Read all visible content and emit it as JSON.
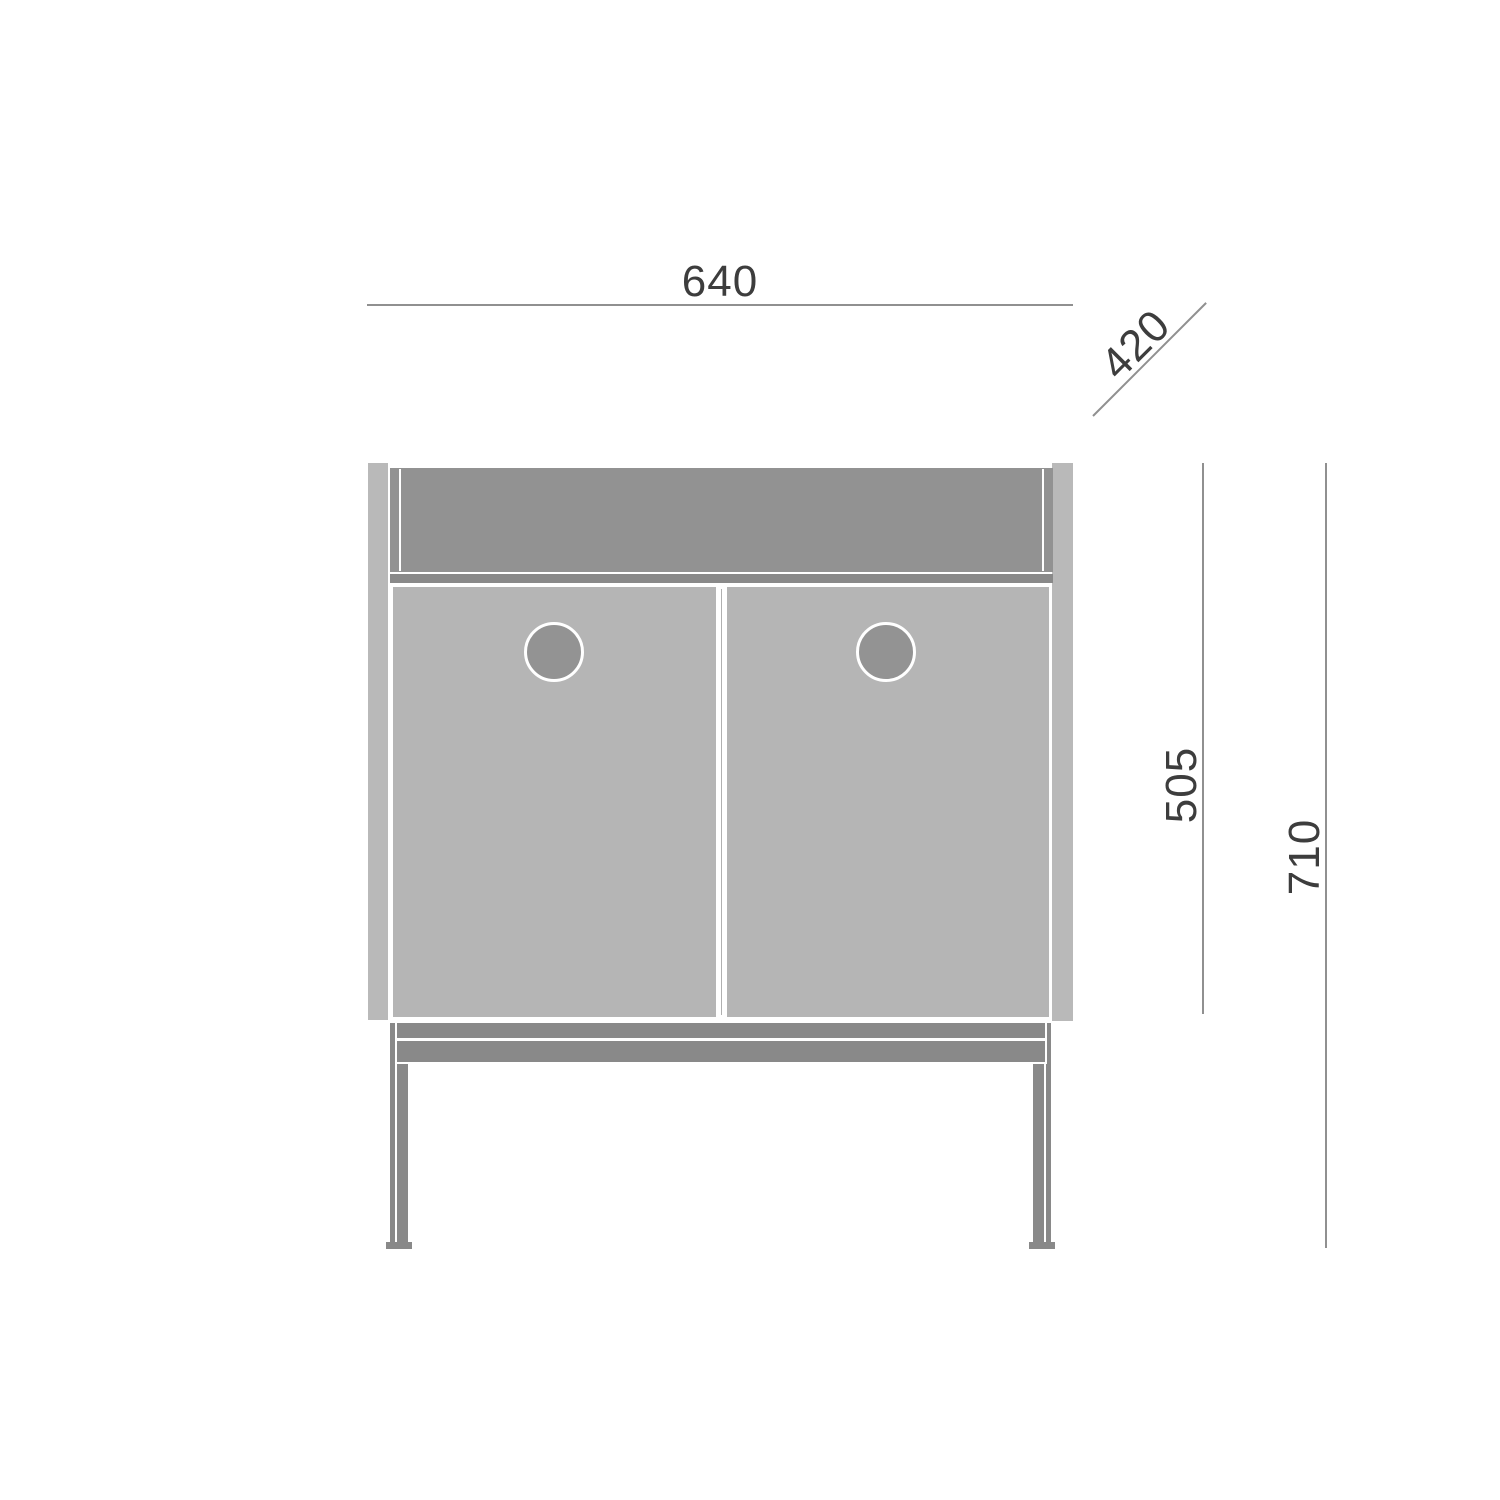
{
  "drawing": {
    "type": "furniture-technical-drawing-front-elevation",
    "dimensions": {
      "width": "640",
      "depth": "420",
      "carcass_height": "505",
      "total_height": "710"
    },
    "colors": {
      "panel_light": "#b9b9b9",
      "door": "#b5b5b5",
      "drawer_band": "#929292",
      "frame_dark": "#898989",
      "handle": "#939393",
      "dim_line": "#909090",
      "dim_text": "#3d3d3d",
      "background": "#ffffff"
    }
  }
}
